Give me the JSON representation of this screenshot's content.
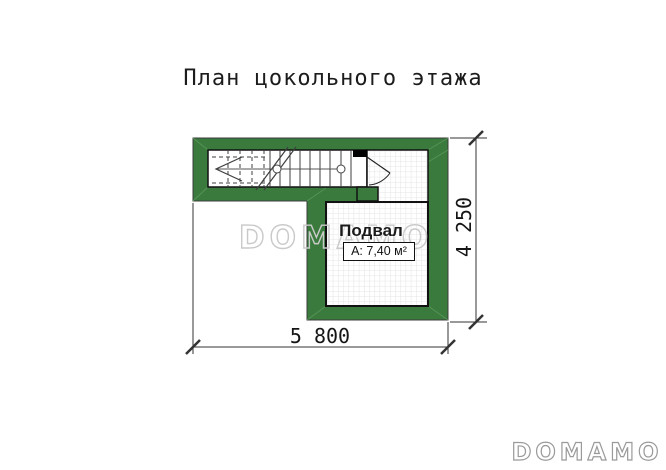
{
  "title": "План цокольного этажа",
  "plan": {
    "room_label": "Подвал",
    "room_area": "А: 7,40 м²",
    "dim_width": "5 800",
    "dim_height": "4 250"
  },
  "watermark": "DOMAMO",
  "logo": "DOMAMO",
  "colors": {
    "wall_green": "#3a7b3d",
    "wall_outline": "#3c3c3c",
    "interior_outline": "#111111",
    "grid_line": "#e4e4e4",
    "watermark_gray": "#c9c9c9",
    "logo_gray": "#9a9a9a"
  }
}
